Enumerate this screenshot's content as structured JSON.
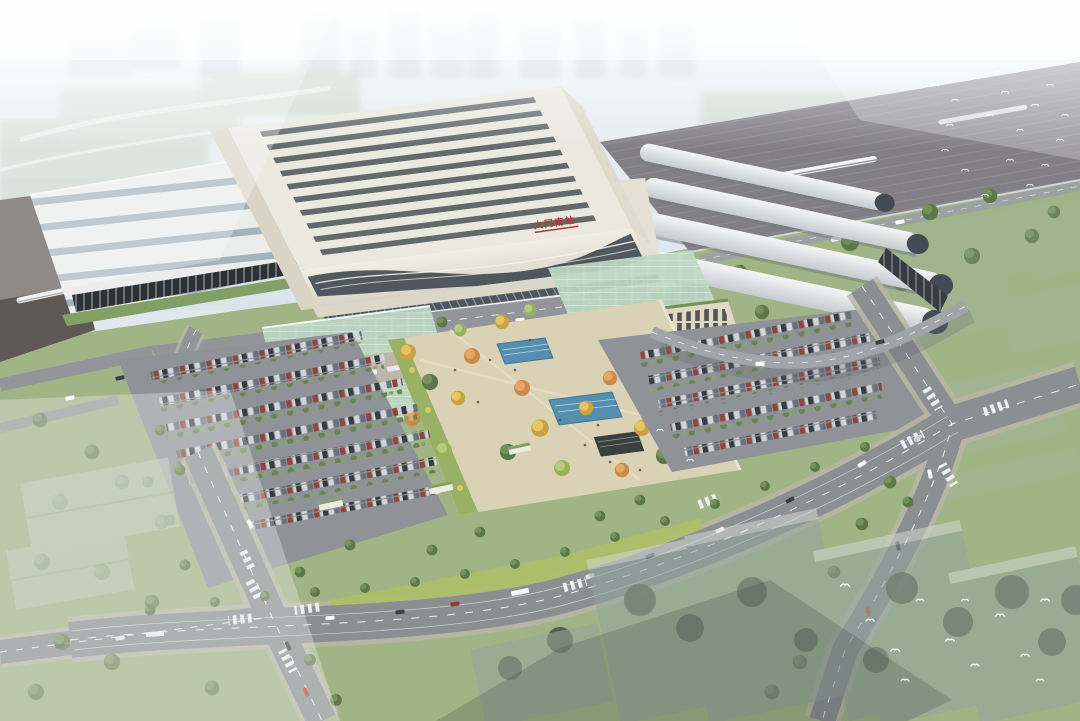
{
  "scene": {
    "type": "aerial-architectural-rendering",
    "subject": "High-speed railway station complex viewed from the air: ribbed-roof main hall with red name sign, platform train sheds on both sides, landscaped forecourt plaza with twin reflecting pools and autumn-coloured trees, flanking surface parking lots full of cars, looping access ramps, a boulevard with two signalised intersections, translucent future-building massing blocks and flocks of white birds, all under hazy daylight",
    "atmosphere": "hazy daylight, background city fades to white"
  },
  "station": {
    "sign": {
      "text": "大同南站",
      "color": "#a93226"
    },
    "roof_skylight_slats": 10,
    "left_shed_rib_bands": 5,
    "right_vault_canopies": 4,
    "trains_visible": 3
  },
  "plaza": {
    "reflecting_pools": 2,
    "sunken_entrances": 1,
    "tree_colors": [
      "#d9b84a",
      "#dd9a4c",
      "#a9c06c",
      "#7a9a55"
    ]
  },
  "parking": {
    "left_lot_rows": 7,
    "right_lot_rows": 5,
    "kiosk_pavilions": 3
  },
  "roads": {
    "intersections": 2,
    "crosswalks": 9,
    "ramps": 2
  },
  "palette": {
    "sky_top": "#f0f4f6",
    "sky_bottom": "#d8e3ea",
    "background_city": "#bcc9d3",
    "field_green": "#b9c8b6",
    "ground_green": "#9cb07f",
    "bright_lawn": "#a9bd62",
    "track_bed": "#7b797e",
    "dark_yard": "#57504b",
    "shed_rib_white": "#e9eceb",
    "shed_glass": "#9eafb9",
    "vault_white": "#eef0f0",
    "roof_cream": "#e9e7de",
    "roof_slat": "#4b545b",
    "facade_cream": "#efece2",
    "facade_glass": "#3a434c",
    "podium": "#d9d5c7",
    "canopy_green": "#b9d6bf",
    "colonnade_beige": "#ded7c0",
    "plaza_paving": "#d9d0b2",
    "plaza_edge_green": "#93ad5c",
    "pool_blue": "#4d88ac",
    "road_asphalt": "#85898d",
    "sidewalk": "#b6b1a2",
    "road_line": "#eef0f1",
    "parking_asphalt": "#898d91",
    "ghost_block": "#8fa099",
    "dark_tree": "#3d4e39",
    "tree_green": "#55713f",
    "bird_white": "#ffffff",
    "car_colors": [
      "#2d3237",
      "#ced3d7",
      "#8d3b33",
      "#5d6b7a"
    ]
  }
}
